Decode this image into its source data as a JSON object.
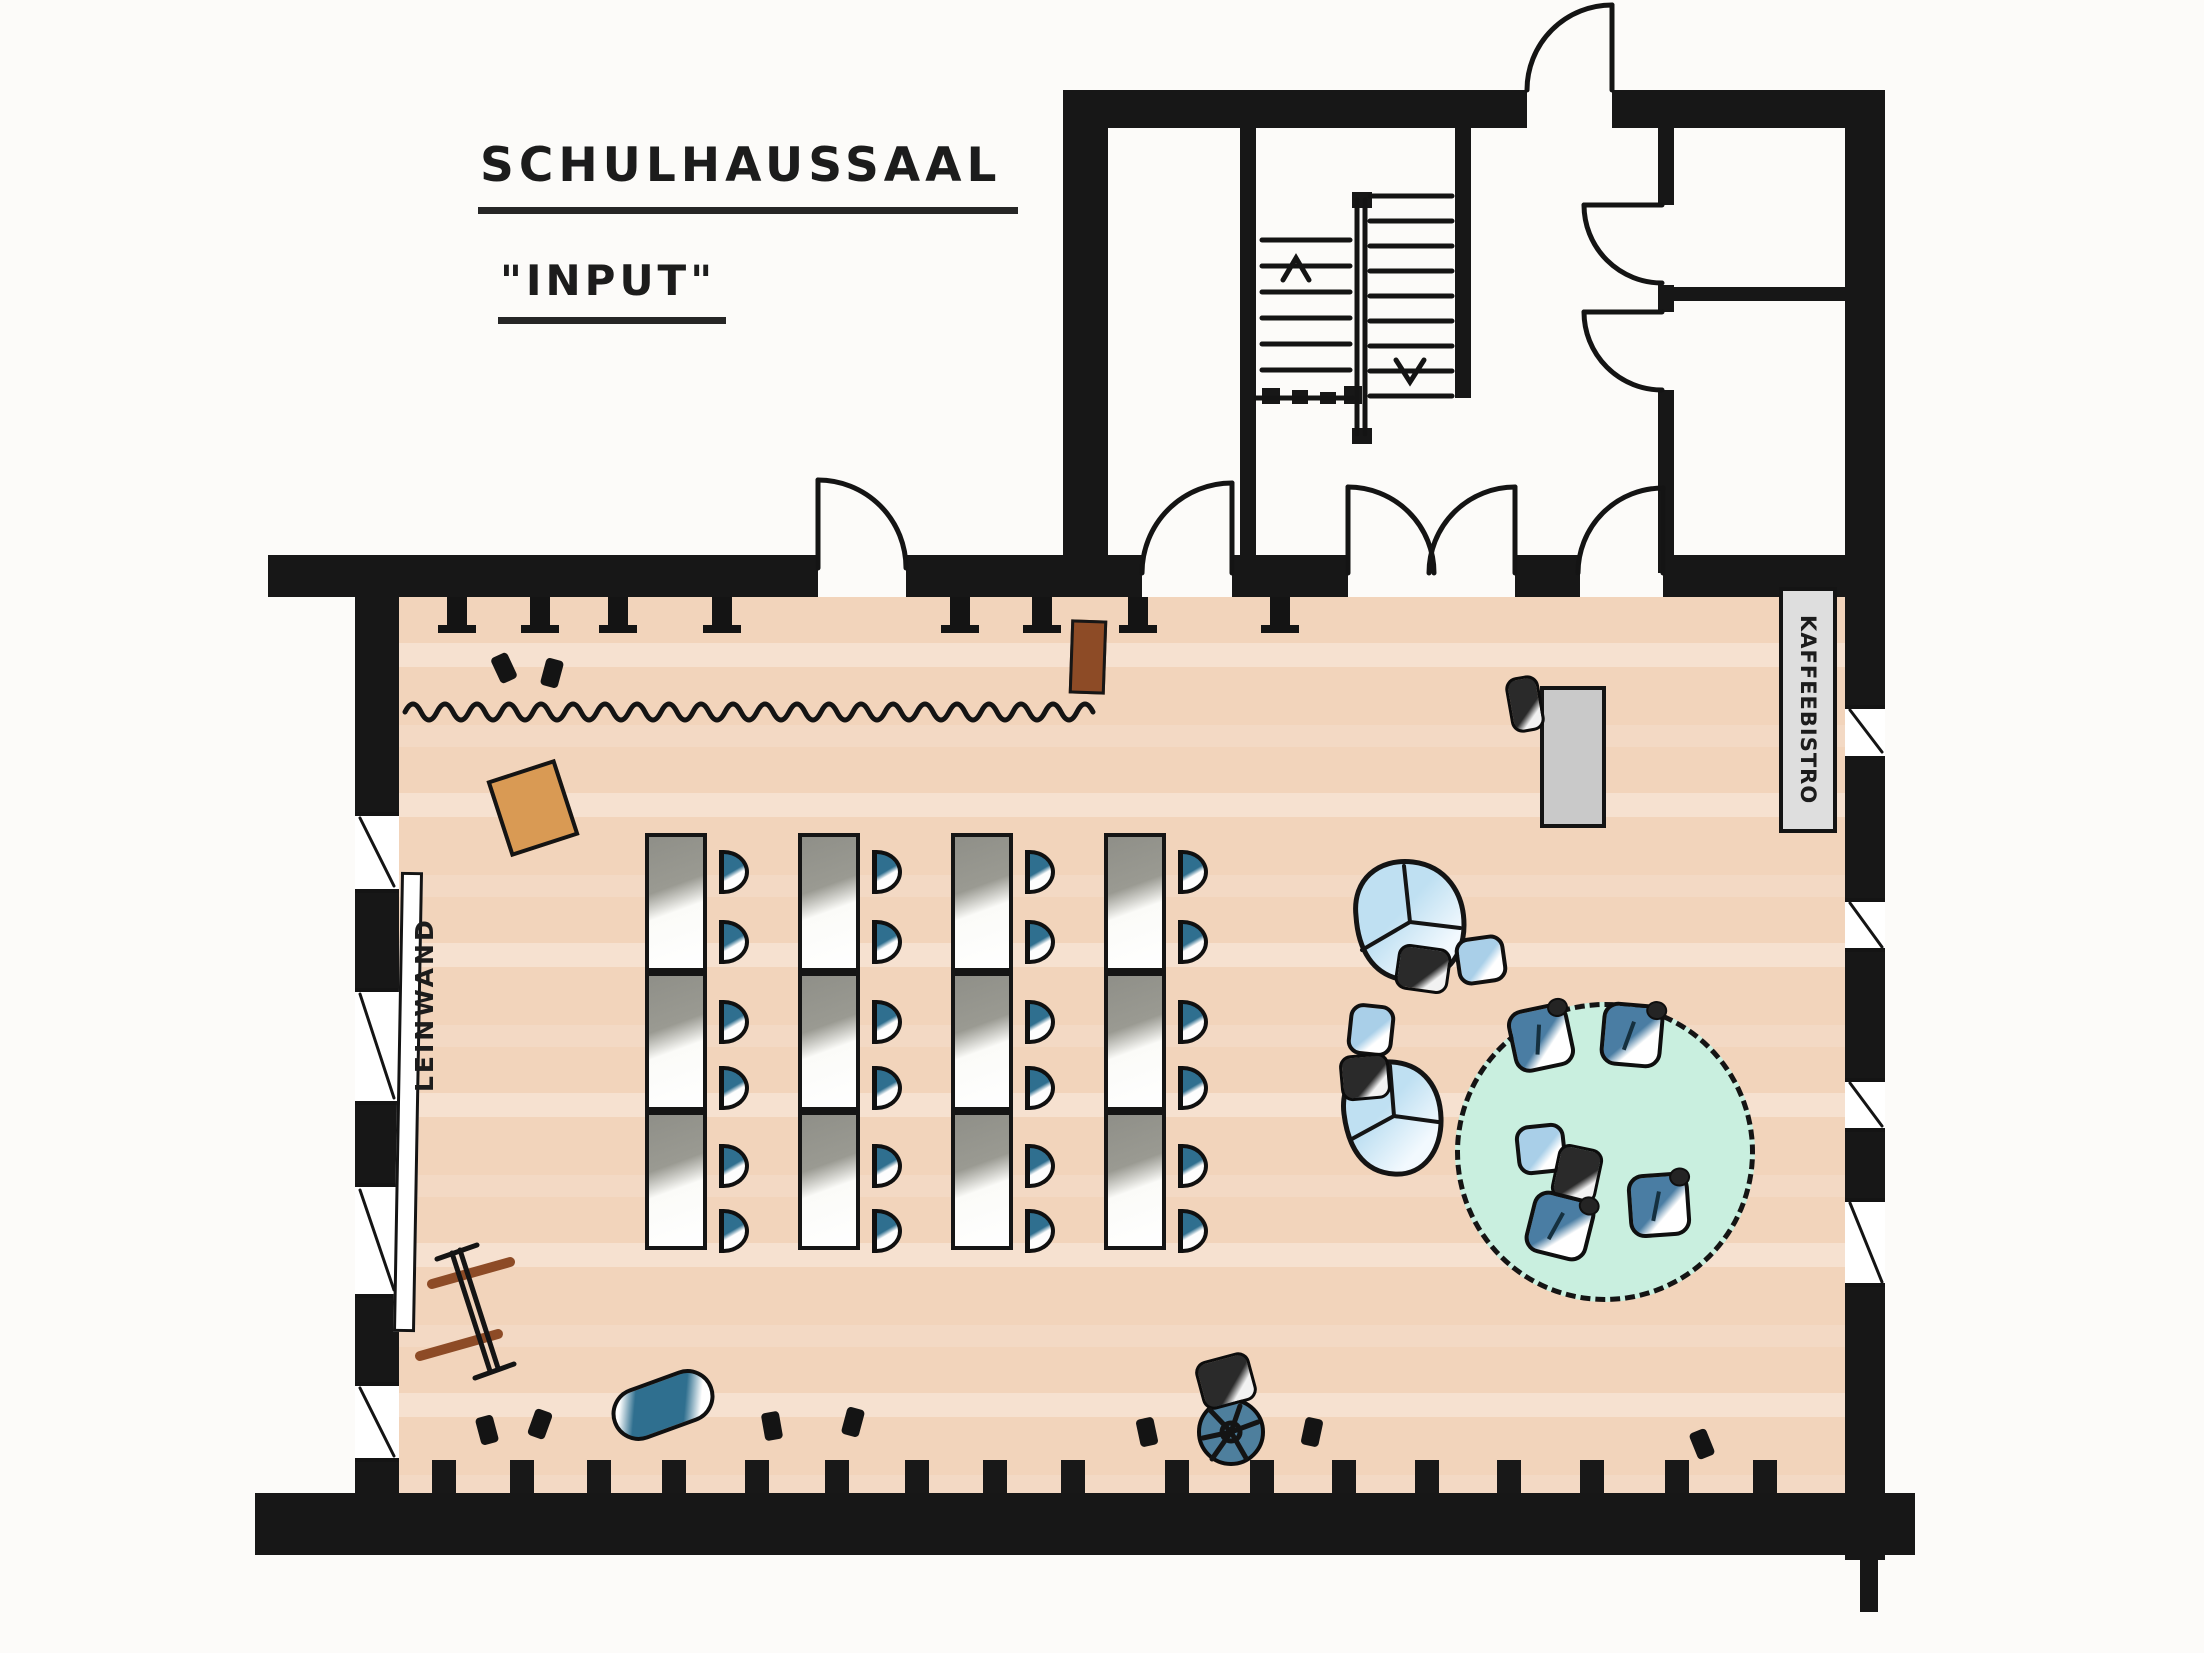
{
  "title": {
    "line1": "SCHULHAUSSAAL",
    "line2": "\"INPUT\""
  },
  "labels": {
    "screen": "LEINWAND",
    "bistro_room": "KAFFEEBISTRO"
  },
  "colors": {
    "wall": "#171717",
    "hall_floor": "#f2d4bb",
    "chair_blue": "#2f6f8f",
    "armchair_blue": "#4a7da3",
    "beanbag_blue": "#bfe0f2",
    "carpet_mint": "#c9efdf",
    "table_grey": "#8f8f88",
    "lectern_orange": "#d99a54",
    "sideboard_brown": "#8d4b26",
    "buffet_grey": "#c9c9c9",
    "bistro_sign_grey": "#dedede"
  },
  "seating": {
    "table_columns": 4,
    "tables_per_column": 3,
    "chairs_per_table": 2,
    "total_audience_chairs": 24,
    "orientation": "chairs face the screen (Leinwand) on the left wall"
  },
  "floorplan": {
    "walls": [
      {
        "n": "hall-top-wall-left",
        "x": 268,
        "y": 555,
        "w": 550,
        "h": 42
      },
      {
        "n": "hall-top-wall-mid",
        "x": 906,
        "y": 555,
        "w": 202,
        "h": 42
      },
      {
        "n": "hall-top-wall-r1",
        "x": 1108,
        "y": 555,
        "w": 34,
        "h": 42
      },
      {
        "n": "hall-top-wall-r2",
        "x": 1232,
        "y": 555,
        "w": 116,
        "h": 42
      },
      {
        "n": "hall-top-wall-r3",
        "x": 1515,
        "y": 555,
        "w": 65,
        "h": 42
      },
      {
        "n": "hall-top-wall-r4",
        "x": 1663,
        "y": 555,
        "w": 222,
        "h": 42
      },
      {
        "n": "hall-bottom-wall",
        "x": 255,
        "y": 1493,
        "w": 1660,
        "h": 62
      },
      {
        "n": "hall-bottom-wall-overshoot",
        "x": 1860,
        "y": 1540,
        "w": 18,
        "h": 72
      },
      {
        "n": "hall-left-wall-1",
        "x": 355,
        "y": 560,
        "w": 44,
        "h": 252
      },
      {
        "n": "hall-left-wall-2",
        "x": 355,
        "y": 893,
        "w": 44,
        "h": 95
      },
      {
        "n": "hall-left-wall-3",
        "x": 355,
        "y": 1105,
        "w": 44,
        "h": 78
      },
      {
        "n": "hall-left-wall-4",
        "x": 355,
        "y": 1298,
        "w": 44,
        "h": 84
      },
      {
        "n": "hall-left-wall-5",
        "x": 355,
        "y": 1462,
        "w": 44,
        "h": 34
      },
      {
        "n": "hall-right-wall-1",
        "x": 1845,
        "y": 555,
        "w": 40,
        "h": 150
      },
      {
        "n": "hall-right-wall-2",
        "x": 1845,
        "y": 760,
        "w": 40,
        "h": 138
      },
      {
        "n": "hall-right-wall-3",
        "x": 1845,
        "y": 952,
        "w": 40,
        "h": 126
      },
      {
        "n": "hall-right-wall-4",
        "x": 1845,
        "y": 1132,
        "w": 40,
        "h": 66
      },
      {
        "n": "hall-right-wall-5",
        "x": 1845,
        "y": 1287,
        "w": 40,
        "h": 273
      },
      {
        "n": "annex-top-wall-left",
        "x": 1063,
        "y": 90,
        "w": 464,
        "h": 38
      },
      {
        "n": "annex-top-wall-right",
        "x": 1612,
        "y": 90,
        "w": 273,
        "h": 38
      },
      {
        "n": "annex-left-wall",
        "x": 1063,
        "y": 90,
        "w": 45,
        "h": 507
      },
      {
        "n": "annex-right-wall",
        "x": 1845,
        "y": 90,
        "w": 40,
        "h": 465
      },
      {
        "n": "annex-inner-wall-vestibule",
        "x": 1240,
        "y": 128,
        "w": 16,
        "h": 445
      },
      {
        "n": "stairwell-right-wall",
        "x": 1455,
        "y": 128,
        "w": 16,
        "h": 270
      },
      {
        "n": "rooms-wall-v-seg1",
        "x": 1658,
        "y": 128,
        "w": 16,
        "h": 77
      },
      {
        "n": "rooms-wall-v-seg2",
        "x": 1658,
        "y": 285,
        "w": 16,
        "h": 27
      },
      {
        "n": "rooms-wall-v-seg3",
        "x": 1658,
        "y": 390,
        "w": 16,
        "h": 183
      },
      {
        "n": "rooms-wall-h",
        "x": 1658,
        "y": 287,
        "w": 196,
        "h": 14
      },
      {
        "n": "stair-landing-post-1",
        "x": 1262,
        "y": 388,
        "w": 18,
        "h": 16
      },
      {
        "n": "stair-landing-post-2",
        "x": 1292,
        "y": 390,
        "w": 16,
        "h": 14
      },
      {
        "n": "stair-landing-post-3",
        "x": 1320,
        "y": 392,
        "w": 16,
        "h": 12
      },
      {
        "n": "stair-landing-post-4",
        "x": 1344,
        "y": 386,
        "w": 18,
        "h": 18
      },
      {
        "n": "stair-rail-cap-top",
        "x": 1352,
        "y": 192,
        "w": 20,
        "h": 16
      },
      {
        "n": "stair-rail-cap-bottom",
        "x": 1352,
        "y": 428,
        "w": 20,
        "h": 16
      }
    ],
    "windows": [
      {
        "n": "left-window-1",
        "x": 355,
        "y": 812,
        "w": 44,
        "h": 81
      },
      {
        "n": "left-window-2",
        "x": 355,
        "y": 988,
        "w": 44,
        "h": 117
      },
      {
        "n": "left-window-3",
        "x": 355,
        "y": 1183,
        "w": 44,
        "h": 115
      },
      {
        "n": "left-window-4",
        "x": 355,
        "y": 1382,
        "w": 44,
        "h": 80
      },
      {
        "n": "right-window-1",
        "x": 1845,
        "y": 705,
        "w": 40,
        "h": 55
      },
      {
        "n": "right-window-2",
        "x": 1845,
        "y": 898,
        "w": 40,
        "h": 54
      },
      {
        "n": "right-window-3",
        "x": 1845,
        "y": 1078,
        "w": 40,
        "h": 54
      },
      {
        "n": "right-window-4",
        "x": 1845,
        "y": 1198,
        "w": 40,
        "h": 89
      }
    ],
    "stubs_top_x": [
      447,
      530,
      608,
      712,
      950,
      1032,
      1128,
      1270
    ],
    "stubs_bottom_x": [
      432,
      510,
      587,
      662,
      745,
      825,
      905,
      983,
      1061,
      1165,
      1250,
      1332,
      1415,
      1497,
      1580,
      1665,
      1753
    ],
    "seating_layout": {
      "table_x": [
        645,
        798,
        951,
        1104
      ],
      "table_y": [
        833,
        972,
        1111
      ],
      "table_w": 62,
      "table_h": 139,
      "chair_x": [
        719,
        872,
        1025,
        1178
      ],
      "chair_y": [
        850,
        920,
        1000,
        1066,
        1144,
        1209
      ],
      "chair_w": 30,
      "chair_h": 44
    },
    "items": [
      {
        "t": "screen",
        "n": "leinwand-screen",
        "x": 397,
        "y": 872,
        "w": 22,
        "h": 460,
        "r": 1
      },
      {
        "t": "or-desk",
        "n": "lectern",
        "x": 497,
        "y": 768,
        "w": 72,
        "h": 80,
        "r": -18
      },
      {
        "t": "brown-box",
        "n": "sideboard",
        "x": 1070,
        "y": 620,
        "w": 36,
        "h": 74,
        "r": 2
      },
      {
        "t": "grey-table",
        "n": "buffet-table",
        "x": 1540,
        "y": 686,
        "w": 66,
        "h": 142,
        "r": 0
      },
      {
        "t": "cushion-dark",
        "n": "buffet-chair",
        "x": 1508,
        "y": 676,
        "w": 34,
        "h": 56,
        "r": -10
      },
      {
        "t": "cushion-dark",
        "n": "beanbag-cushion-a",
        "x": 1396,
        "y": 946,
        "w": 54,
        "h": 46,
        "r": 8
      },
      {
        "t": "pouf-light",
        "n": "cube-pouf-a",
        "x": 1456,
        "y": 936,
        "w": 50,
        "h": 48,
        "r": -8
      },
      {
        "t": "pouf-light",
        "n": "cube-pouf-b",
        "x": 1348,
        "y": 1004,
        "w": 46,
        "h": 52,
        "r": 6
      },
      {
        "t": "cushion-dark",
        "n": "beanbag-cushion-b",
        "x": 1340,
        "y": 1054,
        "w": 50,
        "h": 46,
        "r": -5
      },
      {
        "t": "carpet",
        "n": "round-carpet",
        "x": 1455,
        "y": 1002,
        "w": 300,
        "h": 300,
        "r": 0
      },
      {
        "t": "armchair",
        "n": "lounge-armchair-1",
        "x": 1510,
        "y": 1006,
        "w": 62,
        "h": 64,
        "r": -12
      },
      {
        "t": "armchair",
        "n": "lounge-armchair-2",
        "x": 1601,
        "y": 1003,
        "w": 62,
        "h": 64,
        "r": 5
      },
      {
        "t": "pouf-light",
        "n": "carpet-pouf",
        "x": 1516,
        "y": 1124,
        "w": 50,
        "h": 50,
        "r": -6
      },
      {
        "t": "cushion-dark",
        "n": "carpet-dark-pouf",
        "x": 1554,
        "y": 1146,
        "w": 46,
        "h": 56,
        "r": 12
      },
      {
        "t": "armchair",
        "n": "lounge-armchair-3",
        "x": 1528,
        "y": 1194,
        "w": 64,
        "h": 64,
        "r": 14
      },
      {
        "t": "armchair",
        "n": "lounge-armchair-4",
        "x": 1628,
        "y": 1173,
        "w": 62,
        "h": 64,
        "r": -4
      },
      {
        "t": "wheel",
        "n": "round-stool",
        "x": 1197,
        "y": 1398,
        "w": 68,
        "h": 68,
        "r": 0
      },
      {
        "t": "cushion-dark",
        "n": "stool-cushion",
        "x": 1198,
        "y": 1356,
        "w": 56,
        "h": 50,
        "r": -15
      },
      {
        "t": "pill",
        "n": "beanbag-roll",
        "x": 610,
        "y": 1378,
        "w": 106,
        "h": 54,
        "r": -20
      },
      {
        "t": "tick",
        "n": "floor-mark",
        "x": 495,
        "y": 654,
        "w": 18,
        "h": 28,
        "r": -25
      },
      {
        "t": "tick",
        "n": "floor-mark",
        "x": 543,
        "y": 659,
        "w": 18,
        "h": 28,
        "r": 15
      },
      {
        "t": "tick",
        "n": "floor-mark",
        "x": 478,
        "y": 1416,
        "w": 18,
        "h": 28,
        "r": -15
      },
      {
        "t": "tick",
        "n": "floor-mark",
        "x": 531,
        "y": 1410,
        "w": 18,
        "h": 28,
        "r": 20
      },
      {
        "t": "tick",
        "n": "floor-mark",
        "x": 763,
        "y": 1412,
        "w": 18,
        "h": 28,
        "r": -10
      },
      {
        "t": "tick",
        "n": "floor-mark",
        "x": 844,
        "y": 1408,
        "w": 18,
        "h": 28,
        "r": 15
      },
      {
        "t": "tick",
        "n": "floor-mark",
        "x": 1138,
        "y": 1418,
        "w": 18,
        "h": 28,
        "r": -12
      },
      {
        "t": "tick",
        "n": "floor-mark",
        "x": 1303,
        "y": 1418,
        "w": 18,
        "h": 28,
        "r": 12
      },
      {
        "t": "tick",
        "n": "floor-mark",
        "x": 1693,
        "y": 1430,
        "w": 18,
        "h": 28,
        "r": -22
      }
    ],
    "stairs": {
      "flights": [
        {
          "n": "stair-flight-up",
          "x1": 1262,
          "x2": 1350,
          "y0": 240,
          "step": 26,
          "count": 6
        },
        {
          "n": "stair-flight-down",
          "x1": 1370,
          "x2": 1452,
          "y0": 196,
          "step": 25,
          "count": 9
        }
      ],
      "up_arrow": "left flight",
      "down_arrow": "right flight"
    },
    "curtain_wave": {
      "x1": 405,
      "x2": 1092,
      "y": 712,
      "amp": 16,
      "wavelength": 16
    }
  }
}
